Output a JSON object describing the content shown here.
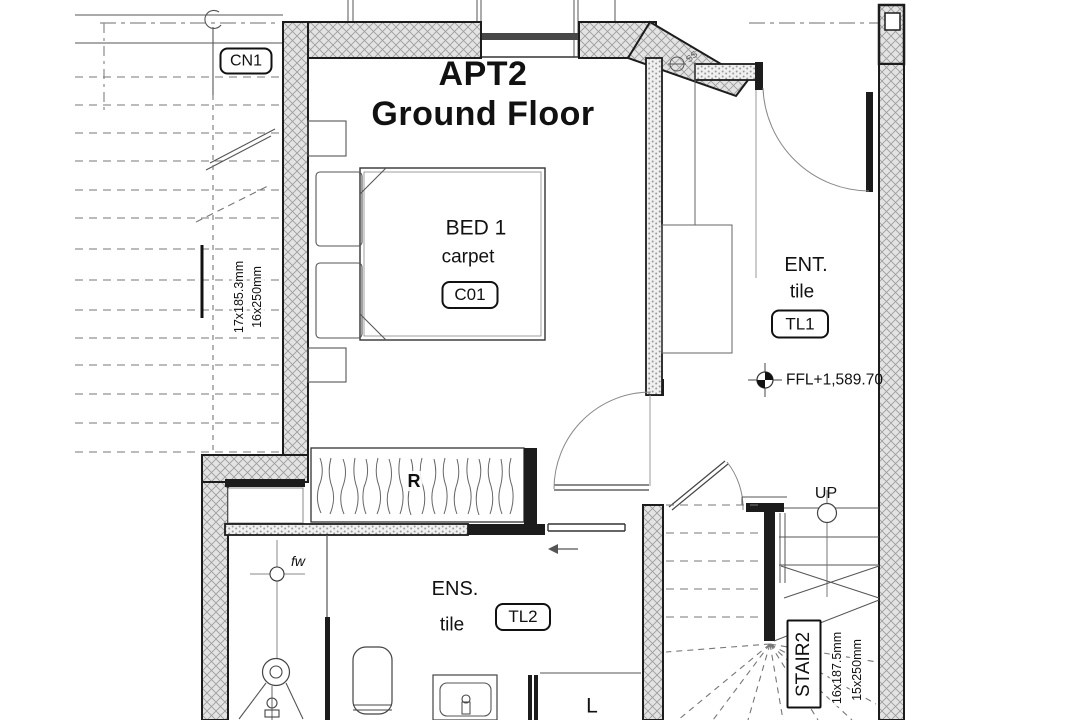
{
  "plan": {
    "title": {
      "line1": "APT2",
      "line2": "Ground Floor"
    },
    "rooms": {
      "bed1": {
        "name": "BED 1",
        "finish": "carpet",
        "code": "C01"
      },
      "ent": {
        "name": "ENT.",
        "finish": "tile",
        "code": "TL1"
      },
      "ens": {
        "name": "ENS.",
        "finish": "tile",
        "code": "TL2"
      }
    },
    "stairs": {
      "cn1": {
        "code": "CN1",
        "dim1": "17x185.3mm",
        "dim2": "16x250mm"
      },
      "stair2": {
        "code": "STAIR2",
        "dim1": "16x187.5mm",
        "dim2": "15x250mm",
        "direction": "UP"
      }
    },
    "annotations": {
      "ffl": "FFL+1,589.70",
      "floor_waste": "fw",
      "soil_stack": "SS",
      "linen": "L",
      "robe": "R"
    },
    "colors": {
      "line": "#1c1c1c",
      "hatch_line": "#9b9b9b",
      "hatch_bg": "#e3e3e3",
      "stipple_dot": "#999999",
      "paper": "#ffffff"
    }
  }
}
